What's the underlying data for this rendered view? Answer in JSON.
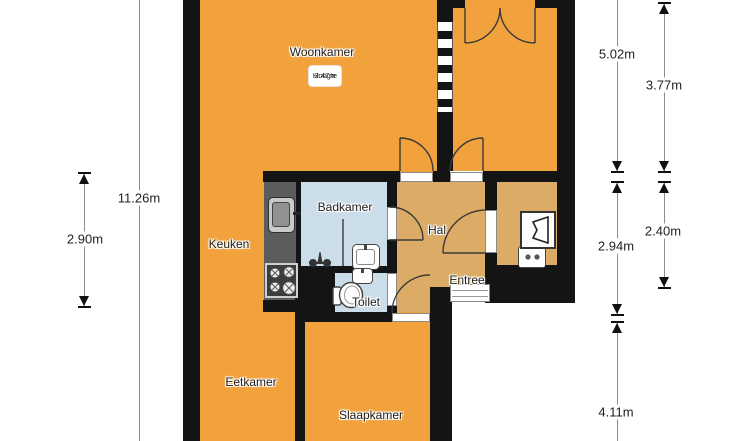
{
  "floorplan": {
    "rooms": {
      "woonkamer": "Woonkamer",
      "keuken": "Keuken",
      "badkamer": "Badkamer",
      "toilet": "Toilet",
      "hal": "Hal",
      "entree": "Entree",
      "eetkamer": "Eetkamer",
      "slaapkamer": "Slaapkamer"
    },
    "height_note": {
      "label": "Hoogte",
      "value": "2.47m"
    },
    "dimensions": {
      "left_total": "11.26m",
      "left_kitchen_section": "2.90m",
      "right_top_outer": "5.02m",
      "right_top_inner": "3.77m",
      "right_mid_outer": "2.94m",
      "right_mid_inner": "2.40m",
      "right_bottom": "4.11m"
    },
    "fixtures": [
      "kitchen-sink",
      "stove",
      "shower",
      "bathroom-sink",
      "hand-basin",
      "toilet-bowl",
      "boiler",
      "power-outlet",
      "front-door",
      "window",
      "interior-doors"
    ],
    "colors": {
      "room_orange": "#F2A23C",
      "hall_tan": "#DCAC67",
      "wet_blue": "#CBDDE9",
      "wall_black": "#141414",
      "counter_gray": "#5C5C5C",
      "background": "#FFFFFF"
    }
  }
}
